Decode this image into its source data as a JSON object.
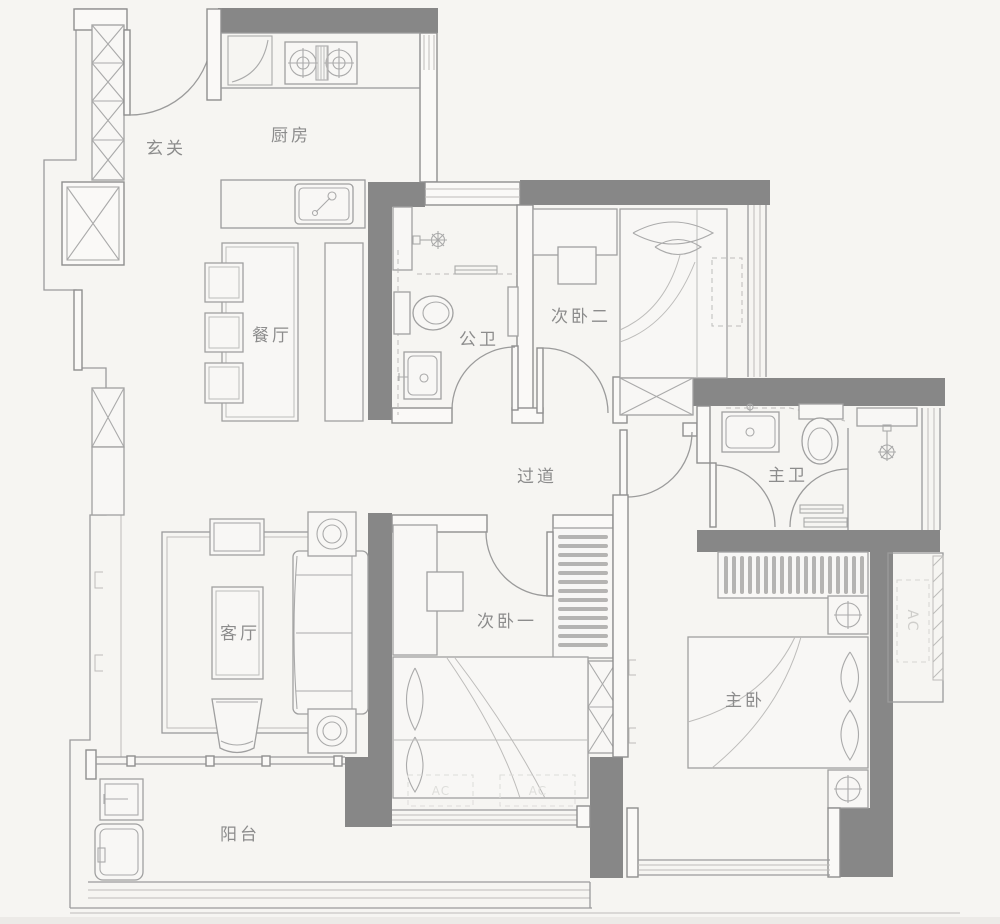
{
  "plan": {
    "type": "apartment-floor-plan",
    "colors": {
      "background": "#f6f5f2",
      "wall": "#878787",
      "line": "#9b9b9b",
      "furniture_line": "#a0a0a0",
      "text": "#8c8c8c"
    },
    "rooms": {
      "entry": {
        "label": "玄关"
      },
      "kitchen": {
        "label": "厨房"
      },
      "dining": {
        "label": "餐厅"
      },
      "guest_bath": {
        "label": "公卫"
      },
      "bedroom2": {
        "label": "次卧二"
      },
      "hallway": {
        "label": "过道"
      },
      "master_bath": {
        "label": "主卫"
      },
      "living": {
        "label": "客厅"
      },
      "bedroom1": {
        "label": "次卧一"
      },
      "master_bedroom": {
        "label": "主卧"
      },
      "balcony": {
        "label": "阳台"
      }
    },
    "annotations": {
      "ac_platform": "AC",
      "floor_ac_left": "AC",
      "floor_ac_right": "AC"
    }
  }
}
